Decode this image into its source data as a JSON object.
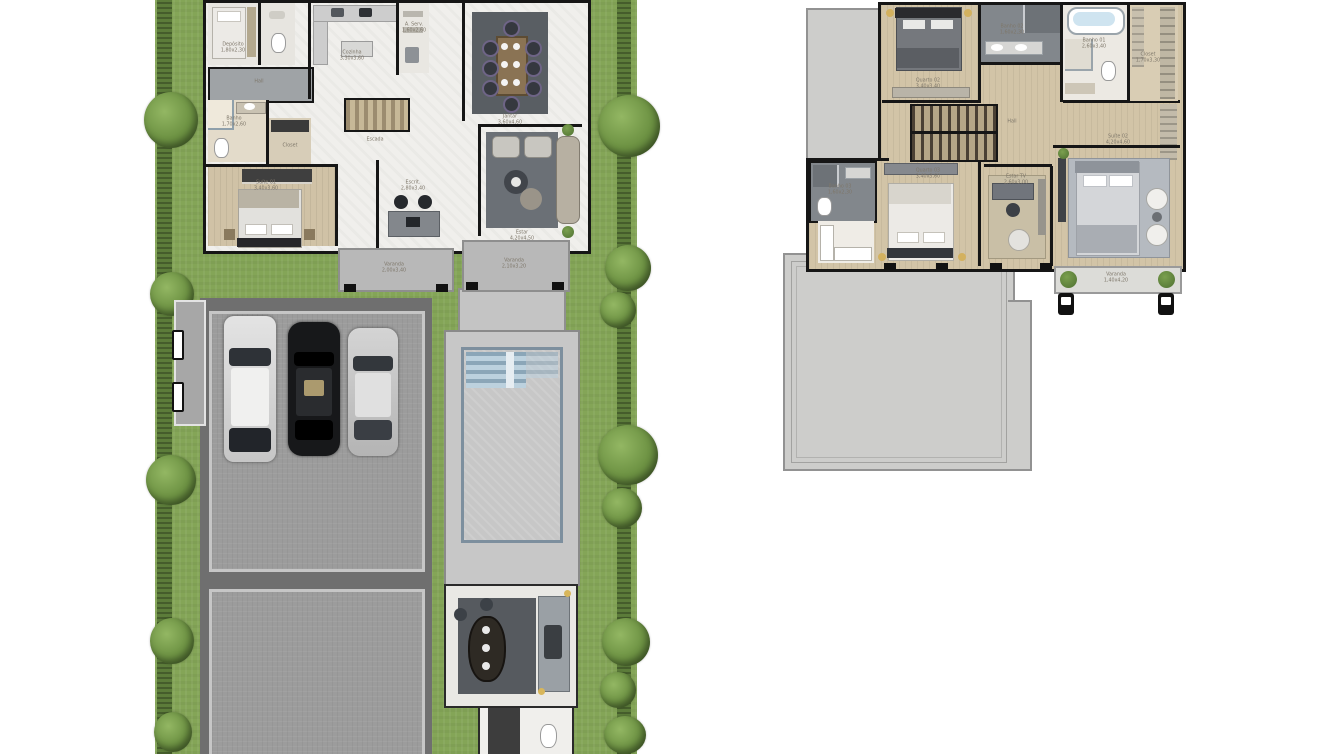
{
  "palette": {
    "grass": "#84a557",
    "hedge": "#5c7c3a",
    "tree": "#6d9243",
    "wall": "#161616",
    "marble_floor": "#f0efec",
    "wood_floor": "#d0c2a6",
    "driveway": "#6f6f6f",
    "paver_slab": "#9c9c9c",
    "pool_deck": "#c7c7c7",
    "pool_water": "#aec8d9",
    "roof_terrace": "#cdcdcb",
    "rug_dark": "#60656b",
    "bath_dark": "#82878c",
    "bath_light": "#e3dbca"
  },
  "site": {
    "name": "ground-floor-site-plan",
    "labels": {
      "maid": "Depósito\n1,80x2,30",
      "hall": "Hall",
      "kitchen": "Cozinha\n3,30x3,60",
      "service": "A. Serv.\n1,60x2,60",
      "dining": "Jantar\n3,60x4,60",
      "stairs": "Escada",
      "living": "Estar\n4,20x4,50",
      "office": "Escrit.\n2,80x3,40",
      "suite1": "Suíte 01\n3,40x3,60",
      "bath1": "Banho\n1,70x2,60",
      "closet1": "Closet",
      "porch_left": "Varanda\n2,00x3,40",
      "porch_right": "Varanda\n2,10x3,20"
    }
  },
  "floor2": {
    "name": "upper-floor-plan",
    "labels": {
      "bedroom2": "Quarto 02\n3,40x3,40",
      "bath2": "Banho 02\n1,60x2,30",
      "master_bath": "Banho 01\n2,60x3,40",
      "closet2": "Closet\n1,70x3,30",
      "hall": "Hall",
      "bedroom3": "Quarto 03\n3,40x3,60",
      "bath3": "Banho 03\n1,60x2,30",
      "tv_room": "Estar TV\n2,60x3,00",
      "master": "Suíte 02\n4,20x4,60",
      "balcony": "Varanda\n1,40x4,20"
    }
  }
}
